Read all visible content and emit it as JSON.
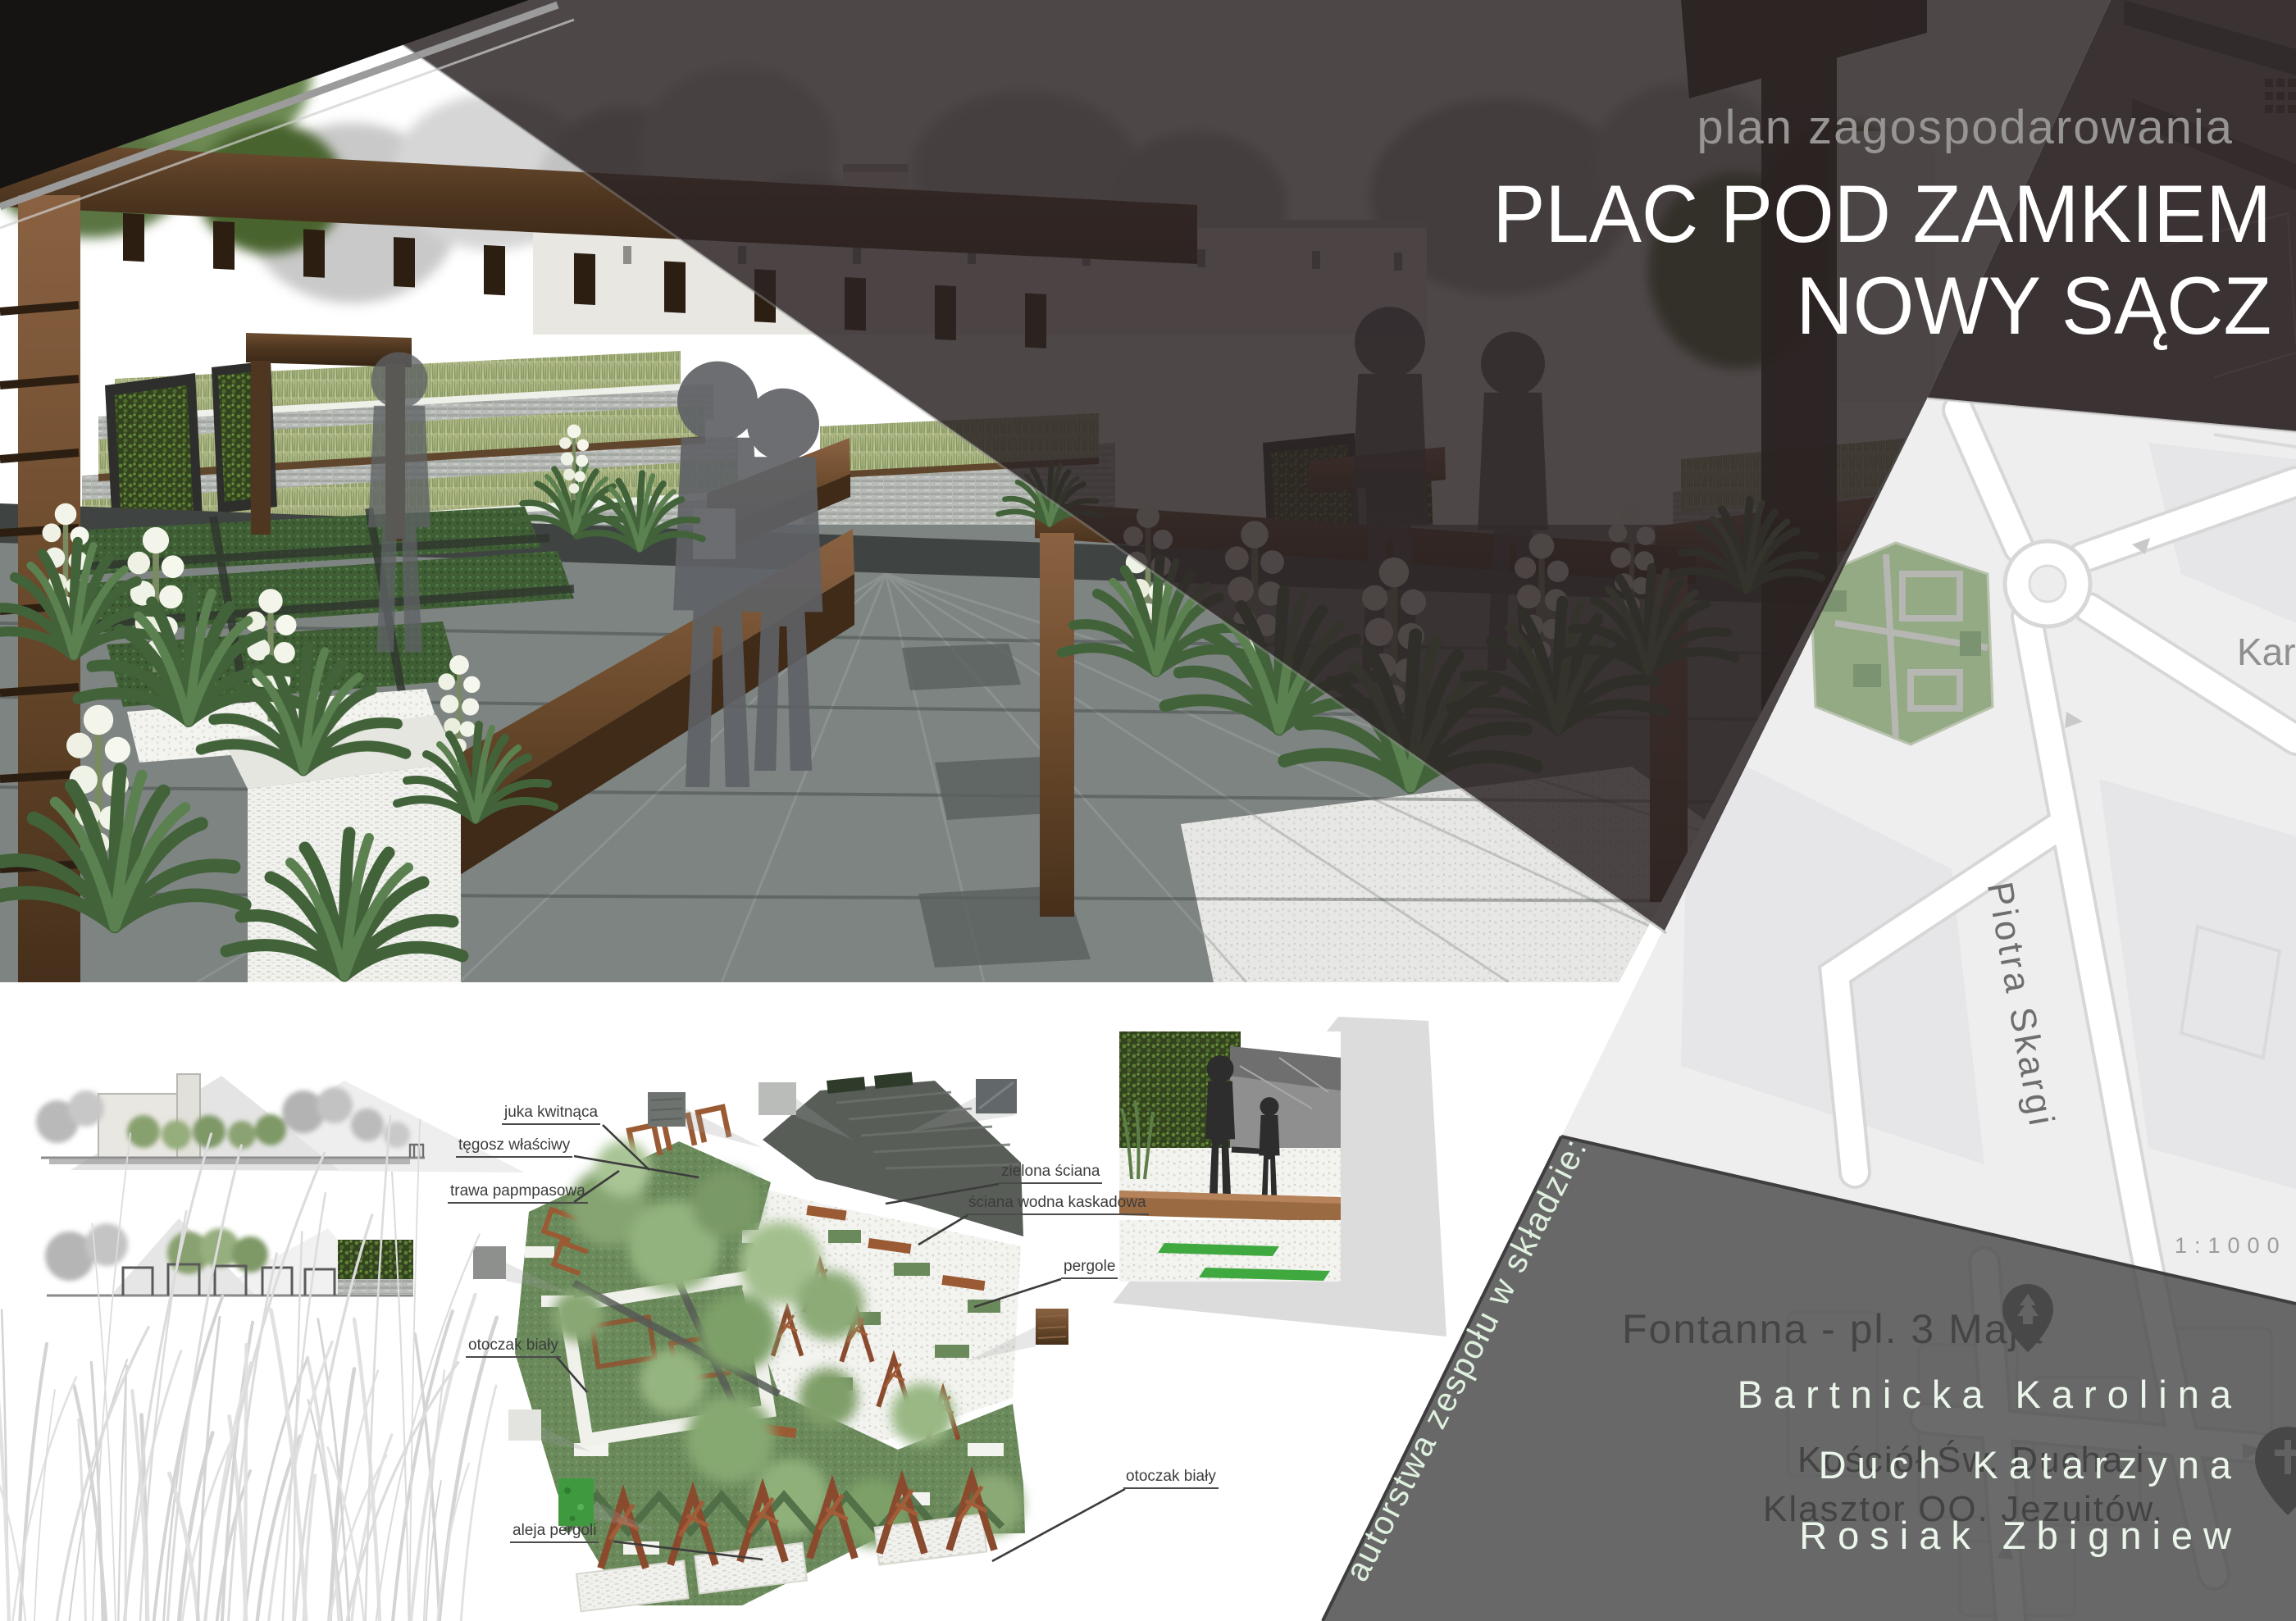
{
  "header": {
    "kicker": "plan zagospodarowania",
    "title_line1": "PLAC POD ZAMKIEM",
    "title_line2": "NOWY SĄCZ"
  },
  "credits": {
    "heading_rotated": "autorstwa zespołu w składzie:",
    "names": [
      "Bartnicka Karolina",
      "Duch Katarzyna",
      "Rosiak Zbigniew"
    ]
  },
  "map": {
    "scale_label": "1:1000",
    "street_label": "Piotra Skargi",
    "street_label_truncated": "Kar",
    "poi_fountain": "Fontanna - pl. 3 Maja",
    "poi_church_line1": "Kościół Św. Ducha i",
    "poi_church_line2": "Klasztor OO. Jezuitów.",
    "icons": [
      "park-pin-icon",
      "church-pin-icon",
      "roundabout"
    ]
  },
  "plan": {
    "labels_left": [
      "juka kwitnąca",
      "tęgosz właściwy",
      "trawa papmpasowa",
      "otoczak biały",
      "aleja pergoli"
    ],
    "labels_right": [
      "zielona ściana",
      "ściana wodna kaskadowa",
      "pergole",
      "otoczak biały"
    ]
  },
  "colors": {
    "band_dark": "#3a3233",
    "overlay_gray": "#4a4a4b",
    "map_bg": "#eeeeef",
    "plan_green": "#6b8a5c",
    "wood": "#6b4a2f",
    "names_text": "#ebf6eb"
  }
}
